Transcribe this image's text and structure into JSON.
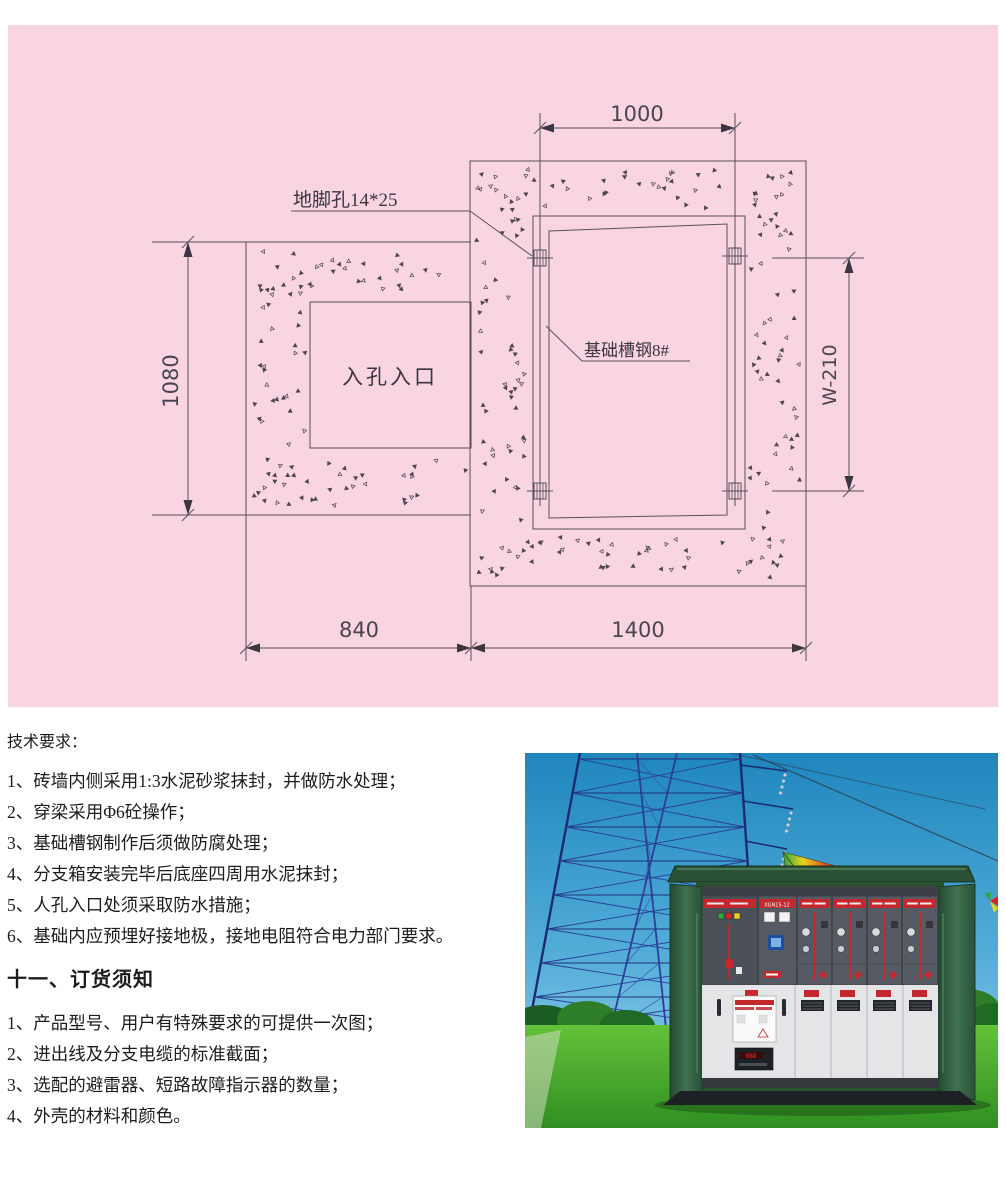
{
  "document": {
    "tech_requirements": {
      "title": "技术要求：",
      "items": [
        "1、砖墙内侧采用1:3水泥砂浆抹封，并做防水处理；",
        "2、穿梁采用Φ6砼操作；",
        "3、基础槽钢制作后须做防腐处理；",
        "4、分支箱安装完毕后底座四周用水泥抹封；",
        "5、人孔入口处须采取防水措施；",
        "6、基础内应预埋好接地极，接地电阻符合电力部门要求。"
      ]
    },
    "ordering_notice": {
      "title": "十一、订货须知",
      "items": [
        "1、产品型号、用户有特殊要求的可提供一次图；",
        "2、进出线及分支电缆的标准截面；",
        "3、选配的避雷器、短路故障指示器的数量；",
        "4、外壳的材料和颜色。"
      ]
    }
  },
  "drawing": {
    "labels": {
      "top_width": "1000",
      "anchor_hole": "地脚孔14*25",
      "left_height": "1080",
      "manhole": "入孔入口",
      "channel_steel": "基础槽钢8#",
      "right_height": "W-210",
      "bottom_left_width": "840",
      "bottom_right_width": "1400"
    },
    "colors": {
      "panel_bg": "#f8d5e1",
      "line": "#56505c"
    }
  },
  "photo": {
    "cabinet_model_label": "XGN15-12",
    "colors": {
      "sky_top": "#1f86bd",
      "sky_bottom": "#a5d7ee",
      "grass": "#46a42c",
      "cabinet_green": "#2f5d3f",
      "accent_red": "#c4272e",
      "tower_blue": "#22307a"
    }
  }
}
